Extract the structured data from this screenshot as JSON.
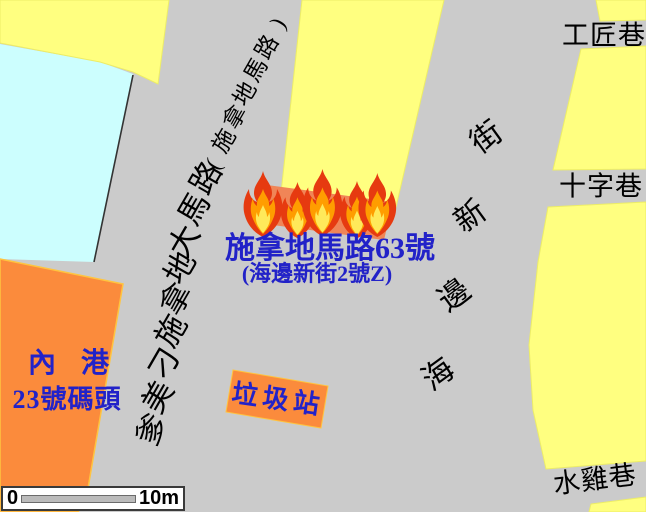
{
  "map_colors": {
    "road_background": "#CBCBCB",
    "building_fill": "#FFFF80",
    "building_stroke": "#EDED66",
    "water_block_fill": "#CCFEFE",
    "pier_fill": "#FB8B3C",
    "pier_stroke": "#FFC43F",
    "burning_building_fill": "#F08557",
    "fire_outer": "#E63A10",
    "fire_mid": "#FF9D00",
    "fire_inner": "#FFE95A",
    "label_blue": "#2222C8",
    "label_black": "#000000",
    "road_edge_line": "#333333"
  },
  "incident": {
    "title": "施拿地馬路63號",
    "subtitle": "(海邊新街2號Z)"
  },
  "pier": {
    "line1": "內 港",
    "line2": "23號碼頭"
  },
  "trash_station": {
    "label": "垃圾站"
  },
  "alleys": {
    "top_right": "工匠巷",
    "middle_right": "十字巷",
    "bottom_right": "水雞巷"
  },
  "streets": {
    "main_road": "爹美刁施拿地大馬路",
    "main_road_alias": "(施拿地馬路)",
    "riverside_street": "海邊新街"
  },
  "scale_bar": {
    "start_label": "0",
    "end_label": "10m"
  }
}
